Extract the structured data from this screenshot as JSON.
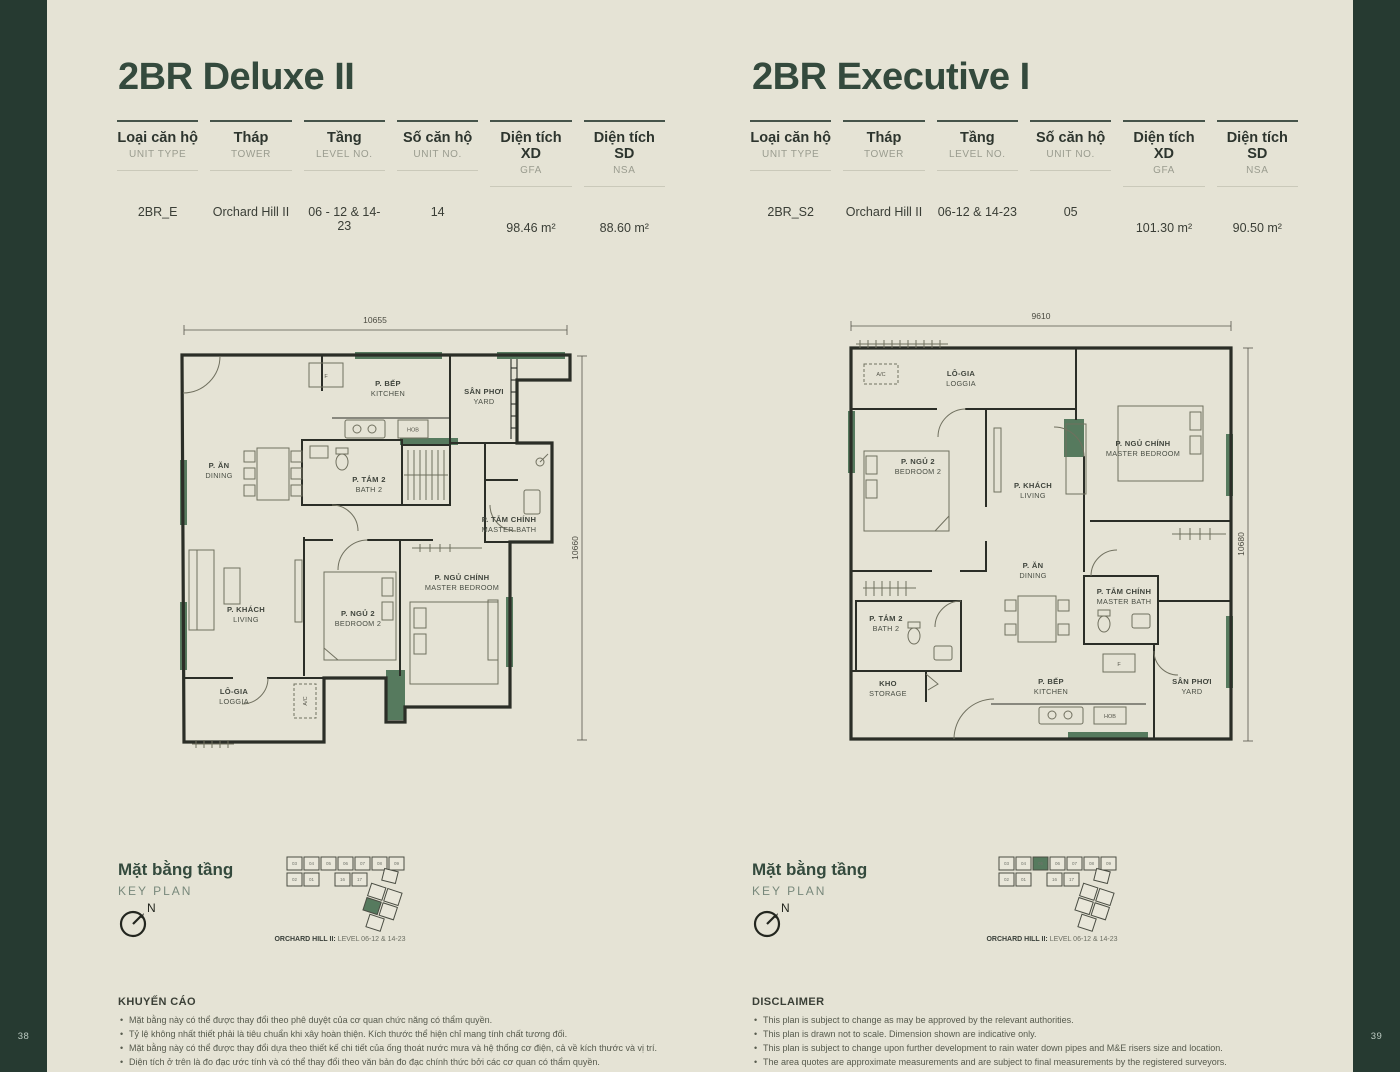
{
  "page": {
    "left_number": "38",
    "right_number": "39"
  },
  "colors": {
    "background": "#e5e3d5",
    "band": "#263a31",
    "heading": "#344a3d",
    "accent_green": "#567a5e"
  },
  "units": [
    {
      "title": "2BR Deluxe II",
      "table": {
        "columns": [
          {
            "vn": "Loại căn hộ",
            "en": "UNIT TYPE"
          },
          {
            "vn": "Tháp",
            "en": "TOWER"
          },
          {
            "vn": "Tầng",
            "en": "LEVEL NO."
          },
          {
            "vn": "Số căn hộ",
            "en": "UNIT NO."
          },
          {
            "vn": "Diện tích XD",
            "en": "GFA"
          },
          {
            "vn": "Diện tích SD",
            "en": "NSA"
          }
        ],
        "values": [
          "2BR_E",
          "Orchard Hill II",
          "06 - 12 & 14-23",
          "14",
          "98.46 m²",
          "88.60 m²"
        ]
      },
      "plan": {
        "dim_width": "10655",
        "dim_height": "10660",
        "rooms": {
          "kitchen_vn": "P. BẾP",
          "kitchen_en": "KITCHEN",
          "yard_vn": "SÂN PHƠI",
          "yard_en": "YARD",
          "dining_vn": "P. ĂN",
          "dining_en": "DINING",
          "bath2_vn": "P. TẮM 2",
          "bath2_en": "BATH 2",
          "master_bath_vn": "P. TẮM CHÍNH",
          "master_bath_en": "MASTER BATH",
          "living_vn": "P. KHÁCH",
          "living_en": "LIVING",
          "bedroom2_vn": "P. NGỦ 2",
          "bedroom2_en": "BEDROOM 2",
          "master_bedroom_vn": "P. NGỦ CHÍNH",
          "master_bedroom_en": "MASTER BEDROOM",
          "loggia_vn": "LÔ-GIA",
          "loggia_en": "LOGGIA",
          "ac": "A/C",
          "fridge": "F",
          "hob": "HOB"
        }
      },
      "keyplan": {
        "heading_vn": "Mặt bằng tầng",
        "heading_en": "KEY PLAN",
        "north": "N",
        "caption_bold": "ORCHARD HILL II:",
        "caption_rest": " LEVEL 06-12 & 14-23",
        "row1": [
          "03",
          "04",
          "05",
          "06",
          "07",
          "08",
          "09"
        ],
        "row2": [
          "02",
          "01",
          "16",
          "17"
        ]
      },
      "disclaimer": {
        "heading": "KHUYẾN CÁO",
        "items": [
          "Mặt bằng này có thể được thay đổi theo phê duyệt của cơ quan chức năng có thẩm quyền.",
          "Tỷ lệ không nhất thiết phải là tiêu chuẩn khi xây hoàn thiện. Kích thước thể hiện chỉ mang tính chất tương đối.",
          "Mặt bằng này có thể được thay đổi dựa theo thiết kế chi tiết của ống thoát nước mưa và hệ thống cơ điện, cả về kích thước và vị trí.",
          "Diện tích ở trên là đo đạc ước tính và có thể thay đổi theo văn bản đo đạc chính thức bởi các cơ quan có thẩm quyền."
        ]
      }
    },
    {
      "title": "2BR Executive I",
      "table": {
        "columns": [
          {
            "vn": "Loại căn hộ",
            "en": "UNIT TYPE"
          },
          {
            "vn": "Tháp",
            "en": "TOWER"
          },
          {
            "vn": "Tầng",
            "en": "LEVEL NO."
          },
          {
            "vn": "Số căn hộ",
            "en": "UNIT NO."
          },
          {
            "vn": "Diện tích XD",
            "en": "GFA"
          },
          {
            "vn": "Diện tích SD",
            "en": "NSA"
          }
        ],
        "values": [
          "2BR_S2",
          "Orchard Hill II",
          "06-12 & 14-23",
          "05",
          "101.30 m²",
          "90.50 m²"
        ]
      },
      "plan": {
        "dim_width": "9610",
        "dim_height": "10680",
        "rooms": {
          "kitchen_vn": "P. BẾP",
          "kitchen_en": "KITCHEN",
          "yard_vn": "SÂN PHƠI",
          "yard_en": "YARD",
          "dining_vn": "P. ĂN",
          "dining_en": "DINING",
          "bath2_vn": "P. TẮM 2",
          "bath2_en": "BATH 2",
          "master_bath_vn": "P. TẮM CHÍNH",
          "master_bath_en": "MASTER BATH",
          "living_vn": "P. KHÁCH",
          "living_en": "LIVING",
          "bedroom2_vn": "P. NGỦ 2",
          "bedroom2_en": "BEDROOM 2",
          "master_bedroom_vn": "P. NGỦ CHÍNH",
          "master_bedroom_en": "MASTER BEDROOM",
          "loggia_vn": "LÔ-GIA",
          "loggia_en": "LOGGIA",
          "storage_vn": "KHO",
          "storage_en": "STORAGE",
          "ac": "A/C",
          "fridge": "F",
          "hob": "HOB"
        }
      },
      "keyplan": {
        "heading_vn": "Mặt bằng tầng",
        "heading_en": "KEY PLAN",
        "north": "N",
        "caption_bold": "ORCHARD HILL II:",
        "caption_rest": " LEVEL 06-12 & 14-23",
        "row1": [
          "03",
          "04",
          "05",
          "06",
          "07",
          "08",
          "09"
        ],
        "row2": [
          "02",
          "01",
          "16",
          "17"
        ]
      },
      "disclaimer": {
        "heading": "DISCLAIMER",
        "items": [
          "This plan is subject to change as may be approved by the relevant authorities.",
          "This plan is drawn not to scale. Dimension shown are indicative only.",
          "This plan is subject to change upon further development to rain water down pipes and M&E risers size and location.",
          "The area quotes are approximate measurements and are subject to final measurements by the registered surveyors."
        ]
      }
    }
  ]
}
